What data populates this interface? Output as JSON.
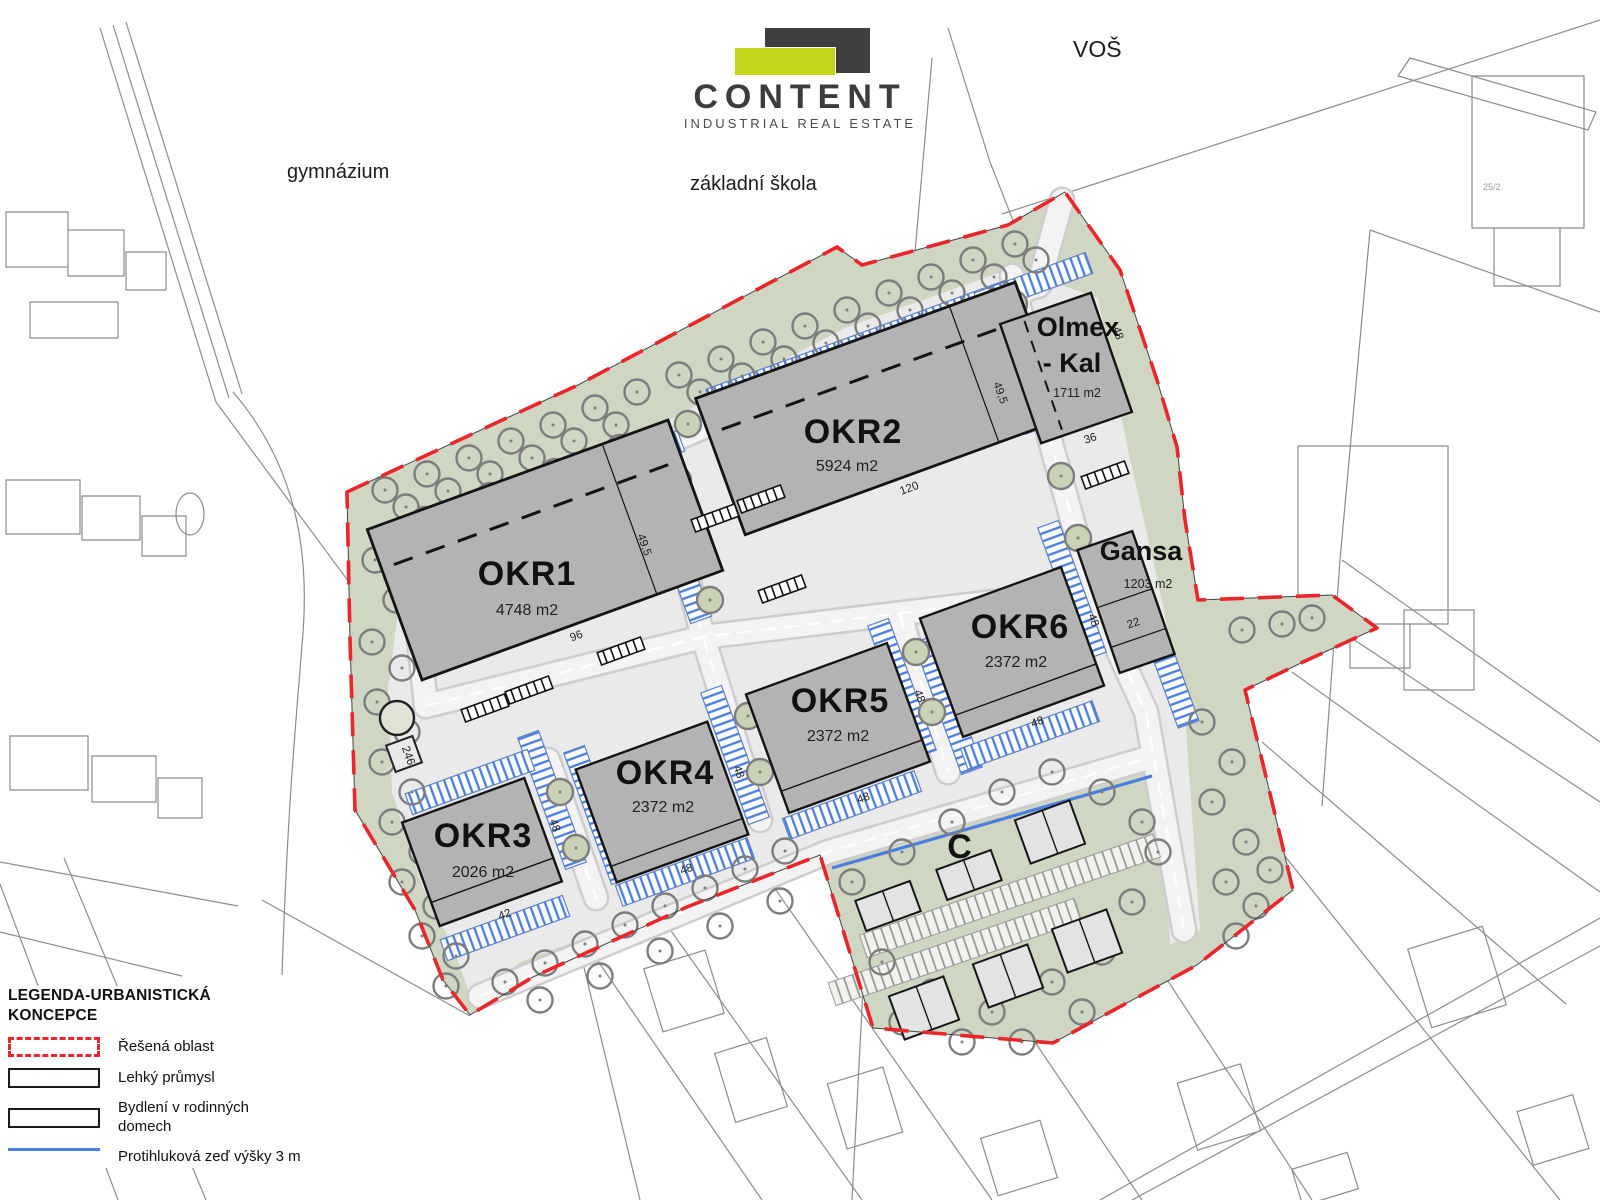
{
  "logo": {
    "name": "CONTENT",
    "tagline": "INDUSTRIAL REAL ESTATE"
  },
  "context_labels": {
    "vos": "VOŠ",
    "gymnazium": "gymnázium",
    "zakladni_skola": "základní škola",
    "parcel": "25/2"
  },
  "buildings": {
    "okr1": {
      "label": "OKR1",
      "area": "4748 m2"
    },
    "okr2": {
      "label": "OKR2",
      "area": "5924 m2"
    },
    "okr3": {
      "label": "OKR3",
      "area": "2026 m2"
    },
    "okr4": {
      "label": "OKR4",
      "area": "2372 m2"
    },
    "okr5": {
      "label": "OKR5",
      "area": "2372 m2"
    },
    "okr6": {
      "label": "OKR6",
      "area": "2372 m2"
    },
    "olmex": {
      "label_line1": "Olmex",
      "label_line2": "- Kal",
      "area": "1711 m2"
    },
    "gansa": {
      "label": "Gansa",
      "area": "1203 m2"
    },
    "c_zone": {
      "label": "C"
    }
  },
  "dims": {
    "okr1_front": "96",
    "okr2_front": "120",
    "okr3_front": "42",
    "okr3_side": "48",
    "okr4_front": "48",
    "okr4_side": "48",
    "okr5_front": "48",
    "okr5_side": "48",
    "okr6_front": "48",
    "okr6_side": "48",
    "olmex_front": "36",
    "olmex_side": "48",
    "gansa_front": "22",
    "road_okr1": "49,5",
    "road_olmex": "49,5",
    "plaza_square": "246"
  },
  "legend": {
    "title": "LEGENDA-URBANISTICKÁ KONCEPCE",
    "items": [
      {
        "label": "Řešená oblast",
        "swatch": "red-dashed-outline"
      },
      {
        "label": "Lehký průmysl",
        "swatch": "black-outline-rect"
      },
      {
        "label": "Bydlení v rodinných domech",
        "swatch": "black-outline-rect"
      },
      {
        "label": "Protihluková zeď výšky 3 m",
        "swatch": "blue-line"
      }
    ]
  },
  "colors": {
    "boundary_red": "#e8262b",
    "parking_blue": "#4a7de0",
    "noise_wall_blue": "#4a7de0",
    "greenery": "#cfd6c2",
    "building_gray": "#b3b3b3",
    "paved_gray": "#eaeaea",
    "logo_yellow": "#c6d41c",
    "logo_dark": "#3f3f3f"
  }
}
